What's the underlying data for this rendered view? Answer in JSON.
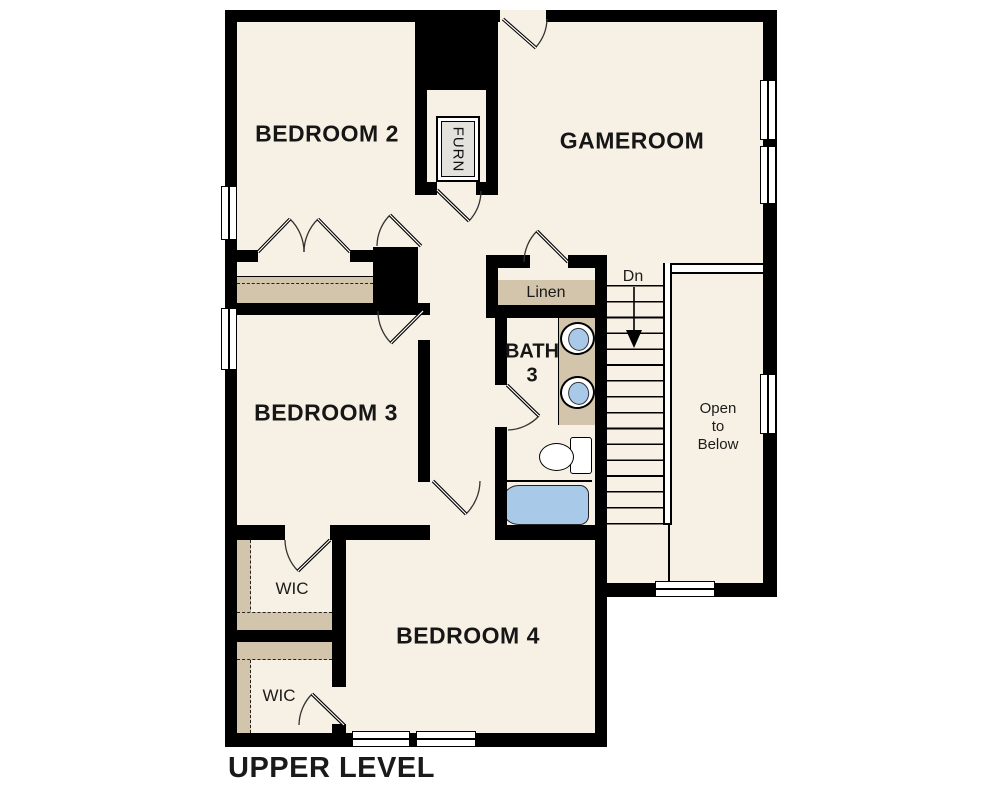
{
  "title": "UPPER LEVEL",
  "rooms": {
    "bedroom2": {
      "label": "BEDROOM 2"
    },
    "gameroom": {
      "label": "GAMEROOM"
    },
    "bedroom3": {
      "label": "BEDROOM 3"
    },
    "bedroom4": {
      "label": "BEDROOM 4"
    },
    "bath3": {
      "line1": "BATH",
      "line2": "3"
    },
    "linen": {
      "label": "Linen"
    },
    "wic_upper": {
      "label": "WIC"
    },
    "wic_lower": {
      "label": "WIC"
    },
    "furn": {
      "label": "FURN"
    },
    "open_to_below": {
      "lines": [
        "Open",
        "to",
        "Below"
      ]
    },
    "stairs": {
      "direction_label": "Dn"
    }
  },
  "colors": {
    "wall": "#000000",
    "floor": "#F7F0E4",
    "shelf_tan": "#D2C5AB",
    "fixture_blue": "#A9C9E8",
    "furn_gray": "#E4E2DC",
    "text": "#161616"
  }
}
